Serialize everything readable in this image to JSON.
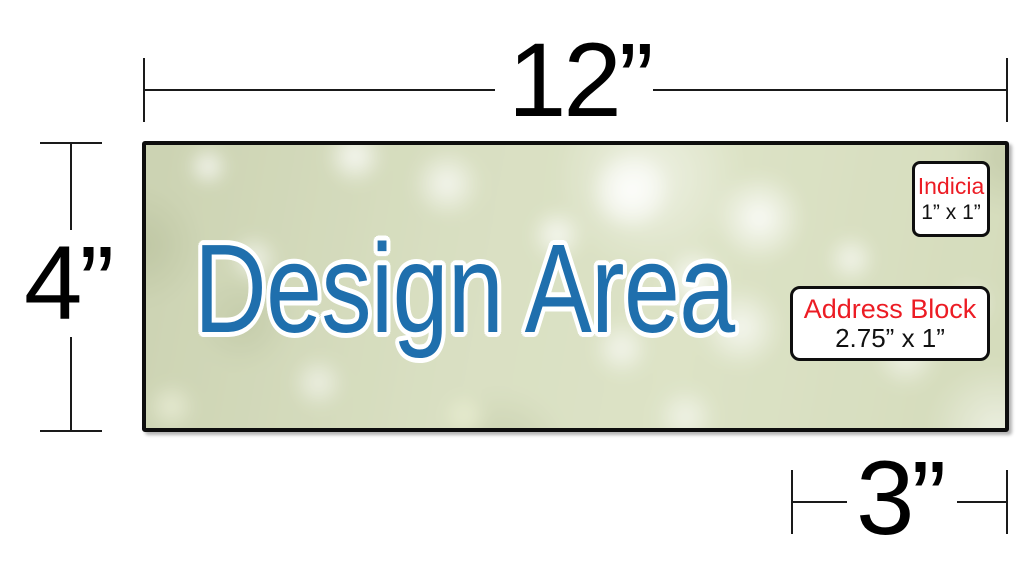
{
  "colors": {
    "design_text": "#1F6FAD",
    "accent_red": "#EC1C24",
    "line": "#1A1A1A"
  },
  "dimensions": {
    "width_label": "12”",
    "height_label": "4”",
    "address_width_label": "3”"
  },
  "design_area": {
    "label": "Design Area"
  },
  "indicia": {
    "title": "Indicia",
    "size": "1” x 1”"
  },
  "address_block": {
    "title": "Address Block",
    "size": "2.75” x 1”"
  }
}
